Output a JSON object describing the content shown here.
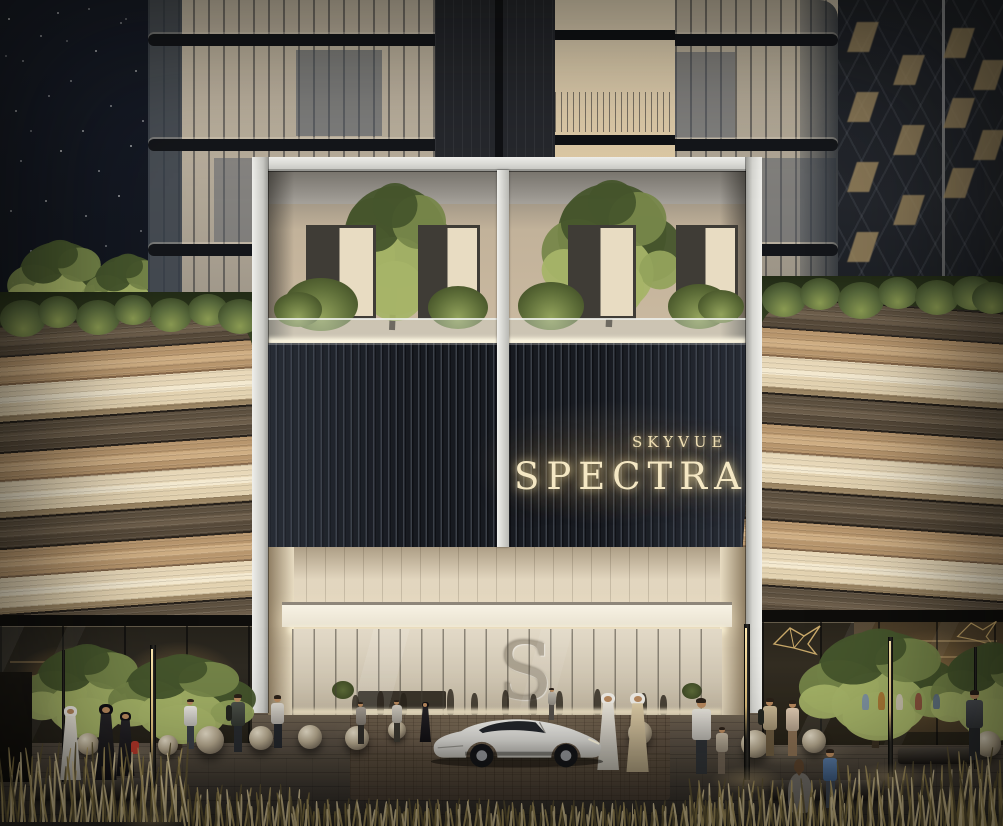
{
  "signage": {
    "brand_top": "SKYVUE",
    "brand_main": "SPECTRA",
    "lobby_monogram": "S"
  },
  "palette": {
    "sky": "#141823",
    "frame_silver": "#dedad2",
    "sign_gold": "#f3e5bd",
    "stripe_dark_brown": "#63543f",
    "stripe_tan": "#c19e74",
    "stripe_cream": "#ead9b8",
    "greenery": "#55663a",
    "glass_warm": "#c7b8a0",
    "slat_wall": "#1c1f26",
    "plaza": "#57503f",
    "car_body": "#e6e5e1"
  },
  "scene": {
    "stars": [
      [
        8,
        18,
        0.8
      ],
      [
        22,
        60,
        0.5
      ],
      [
        40,
        35,
        0.6
      ],
      [
        57,
        12,
        0.7
      ],
      [
        70,
        80,
        0.5
      ],
      [
        15,
        110,
        0.6
      ],
      [
        95,
        50,
        0.7
      ],
      [
        120,
        22,
        0.5
      ],
      [
        135,
        70,
        0.6
      ],
      [
        48,
        95,
        0.5
      ],
      [
        82,
        130,
        0.6
      ],
      [
        110,
        105,
        0.5
      ],
      [
        20,
        160,
        0.5
      ],
      [
        60,
        150,
        0.7
      ],
      [
        98,
        170,
        0.5
      ],
      [
        130,
        145,
        0.6
      ],
      [
        10,
        210,
        0.5
      ],
      [
        45,
        200,
        0.6
      ],
      [
        85,
        215,
        0.5
      ],
      [
        118,
        195,
        0.6
      ],
      [
        140,
        230,
        0.4
      ],
      [
        30,
        250,
        0.5
      ],
      [
        70,
        255,
        0.5
      ],
      [
        105,
        245,
        0.4
      ],
      [
        132,
        268,
        0.5
      ],
      [
        12,
        282,
        0.4
      ],
      [
        55,
        285,
        0.4
      ],
      [
        90,
        280,
        0.4
      ],
      [
        125,
        18,
        0.4
      ],
      [
        5,
        55,
        0.4
      ],
      [
        66,
        40,
        0.4
      ],
      [
        88,
        8,
        0.5
      ],
      [
        30,
        130,
        0.4
      ],
      [
        142,
        120,
        0.5
      ]
    ],
    "bg_windows": [
      [
        14,
        22
      ],
      [
        14,
        92
      ],
      [
        14,
        162
      ],
      [
        14,
        232
      ],
      [
        60,
        55
      ],
      [
        60,
        125
      ],
      [
        60,
        195
      ],
      [
        110,
        28
      ],
      [
        110,
        98
      ],
      [
        110,
        168
      ],
      [
        140,
        60
      ],
      [
        140,
        130
      ]
    ],
    "sky_trees": [
      [
        0,
        238,
        120,
        95
      ],
      [
        78,
        252,
        100,
        82
      ]
    ],
    "greens_left": [
      [
        0,
        300,
        46
      ],
      [
        38,
        296,
        40
      ],
      [
        76,
        300,
        44
      ],
      [
        114,
        295,
        38
      ],
      [
        150,
        298,
        42
      ],
      [
        188,
        294,
        40
      ],
      [
        218,
        299,
        44
      ]
    ],
    "greens_right": [
      [
        762,
        282,
        44
      ],
      [
        800,
        278,
        40
      ],
      [
        838,
        282,
        46
      ],
      [
        878,
        277,
        40
      ],
      [
        915,
        280,
        44
      ],
      [
        952,
        276,
        42
      ],
      [
        972,
        282,
        40
      ]
    ],
    "terrace_trees": [
      [
        52,
        10,
        150,
        150
      ],
      [
        264,
        7,
        160,
        150
      ]
    ],
    "terrace_bushes": [
      [
        16,
        108,
        74
      ],
      [
        160,
        116,
        60
      ],
      [
        250,
        112,
        66
      ],
      [
        400,
        114,
        62
      ],
      [
        6,
        122,
        48
      ],
      [
        430,
        120,
        46
      ]
    ],
    "terrace_windows": [
      [
        38,
        55,
        64,
        88
      ],
      [
        150,
        55,
        56,
        88
      ],
      [
        300,
        55,
        62,
        88
      ],
      [
        408,
        55,
        56,
        88
      ]
    ],
    "street_trees": [
      [
        12,
        642,
        150,
        103
      ],
      [
        98,
        652,
        168,
        98
      ],
      [
        788,
        626,
        182,
        122
      ],
      [
        922,
        640,
        142,
        108
      ]
    ],
    "people": [
      {
        "x": 55,
        "y": 706,
        "h": 74,
        "type": "kandura"
      },
      {
        "x": 90,
        "y": 704,
        "h": 76,
        "type": "abaya"
      },
      {
        "x": 112,
        "y": 712,
        "h": 64,
        "type": "abaya",
        "bag": "#b5372a"
      },
      {
        "x": 180,
        "y": 699,
        "h": 50,
        "type": "casual",
        "shirt": "#e9e6df",
        "pants": "#3a3f46"
      },
      {
        "x": 226,
        "y": 695,
        "h": 57,
        "type": "casual",
        "shirt": "#3f443c",
        "pants": "#282b2f",
        "backpack": true
      },
      {
        "x": 267,
        "y": 696,
        "h": 52,
        "type": "casual",
        "shirt": "#d9d4cb",
        "pants": "#23262b"
      },
      {
        "x": 352,
        "y": 702,
        "h": 42,
        "type": "casual",
        "shirt": "#9c9489",
        "pants": "#2f2d29"
      },
      {
        "x": 388,
        "y": 700,
        "h": 42,
        "type": "casual",
        "shirt": "#cfc9bd",
        "pants": "#3a372f"
      },
      {
        "x": 417,
        "y": 702,
        "h": 40,
        "type": "abaya"
      },
      {
        "x": 592,
        "y": 693,
        "h": 77,
        "type": "kandura"
      },
      {
        "x": 621,
        "y": 693,
        "h": 79,
        "type": "kandura",
        "robe": "#dcc9a1"
      },
      {
        "x": 686,
        "y": 699,
        "h": 75,
        "type": "casual",
        "shirt": "#e6e2da",
        "pants": "#2e3135"
      },
      {
        "x": 712,
        "y": 727,
        "h": 47,
        "type": "child",
        "shirt": "#bdb09a",
        "pants": "#6d6052"
      },
      {
        "x": 758,
        "y": 699,
        "h": 57,
        "type": "casual",
        "shirt": "#c9b58f",
        "pants": "#6b5a3f",
        "backpack": true
      },
      {
        "x": 781,
        "y": 701,
        "h": 55,
        "type": "casual",
        "shirt": "#e0c9ae",
        "pants": "#8a6f52"
      },
      {
        "x": 960,
        "y": 691,
        "h": 69,
        "type": "casual",
        "shirt": "#41454a",
        "pants": "#26282c"
      },
      {
        "x": 545,
        "y": 688,
        "h": 32,
        "type": "casual",
        "shirt": "#b8b2a6",
        "pants": "#55504a"
      },
      {
        "x": 788,
        "y": 757,
        "h": 56,
        "type": "seated",
        "shirt": "#6f6b65",
        "hair": "#58402b"
      },
      {
        "x": 818,
        "y": 750,
        "h": 58,
        "type": "child",
        "shirt": "#4a6e9c",
        "pants": "#3c434d"
      }
    ],
    "lobby_people": [
      [
        60,
        20
      ],
      [
        85,
        24
      ],
      [
        108,
        22
      ],
      [
        155,
        26
      ],
      [
        179,
        22
      ],
      [
        210,
        25
      ],
      [
        238,
        21
      ],
      [
        264,
        24
      ],
      [
        302,
        26
      ],
      [
        348,
        22
      ],
      [
        368,
        20
      ]
    ],
    "store_people": [
      [
        862,
        694,
        16,
        "#7a8ea6"
      ],
      [
        878,
        692,
        18,
        "#a6702f"
      ],
      [
        896,
        694,
        16,
        "#ccc2b2"
      ],
      [
        915,
        693,
        17,
        "#8a4a3a"
      ],
      [
        933,
        694,
        15,
        "#5c6e86"
      ]
    ],
    "spheres": [
      [
        88,
        744,
        11
      ],
      [
        168,
        745,
        10
      ],
      [
        210,
        740,
        14
      ],
      [
        261,
        738,
        12
      ],
      [
        310,
        737,
        12
      ],
      [
        357,
        738,
        12
      ],
      [
        397,
        730,
        9
      ],
      [
        640,
        733,
        12
      ],
      [
        755,
        744,
        14
      ],
      [
        814,
        741,
        12
      ],
      [
        988,
        744,
        13
      ]
    ],
    "poles": [
      [
        62,
        650,
        132,
        3,
        0
      ],
      [
        150,
        645,
        175,
        6,
        1
      ],
      [
        744,
        624,
        156,
        6,
        1
      ],
      [
        888,
        637,
        140,
        5,
        1
      ],
      [
        974,
        647,
        122,
        3,
        0
      ]
    ],
    "benches": [
      [
        33,
        778,
        108,
        22
      ],
      [
        898,
        748,
        76,
        16
      ],
      [
        770,
        780,
        112,
        20
      ]
    ],
    "pools": [
      [
        330,
        700,
        340,
        60
      ],
      [
        60,
        738,
        130,
        30
      ],
      [
        720,
        732,
        140,
        34
      ]
    ],
    "grass": [
      [
        0,
        738,
        188,
        84
      ],
      [
        186,
        782,
        118,
        44
      ],
      [
        295,
        796,
        205,
        30
      ],
      [
        500,
        799,
        235,
        27
      ],
      [
        688,
        775,
        158,
        51
      ],
      [
        838,
        758,
        168,
        68
      ],
      [
        950,
        742,
        53,
        84
      ]
    ]
  }
}
